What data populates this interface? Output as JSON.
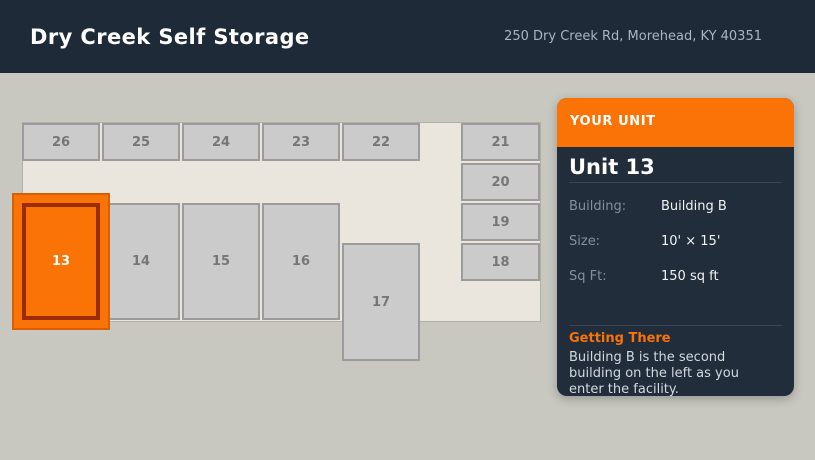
{
  "header": {
    "title": "Dry Creek Self Storage",
    "address": "250 Dry Creek Rd, Morehead, KY 40351"
  },
  "map": {
    "units": [
      {
        "label": "26",
        "x": 22,
        "y": 123,
        "w": 78,
        "h": 38,
        "highlighted": false
      },
      {
        "label": "25",
        "x": 102,
        "y": 123,
        "w": 78,
        "h": 38,
        "highlighted": false
      },
      {
        "label": "24",
        "x": 182,
        "y": 123,
        "w": 78,
        "h": 38,
        "highlighted": false
      },
      {
        "label": "23",
        "x": 262,
        "y": 123,
        "w": 78,
        "h": 38,
        "highlighted": false
      },
      {
        "label": "22",
        "x": 342,
        "y": 123,
        "w": 78,
        "h": 38,
        "highlighted": false
      },
      {
        "label": "21",
        "x": 461,
        "y": 123,
        "w": 79,
        "h": 38,
        "highlighted": false
      },
      {
        "label": "20",
        "x": 461,
        "y": 163,
        "w": 79,
        "h": 38,
        "highlighted": false
      },
      {
        "label": "19",
        "x": 461,
        "y": 203,
        "w": 79,
        "h": 38,
        "highlighted": false
      },
      {
        "label": "18",
        "x": 461,
        "y": 243,
        "w": 79,
        "h": 38,
        "highlighted": false
      },
      {
        "label": "14",
        "x": 102,
        "y": 203,
        "w": 78,
        "h": 117,
        "highlighted": false
      },
      {
        "label": "15",
        "x": 182,
        "y": 203,
        "w": 78,
        "h": 117,
        "highlighted": false
      },
      {
        "label": "16",
        "x": 262,
        "y": 203,
        "w": 78,
        "h": 117,
        "highlighted": false
      },
      {
        "label": "17",
        "x": 342,
        "y": 243,
        "w": 78,
        "h": 118,
        "highlighted": false
      },
      {
        "label": "13",
        "x": 22,
        "y": 203,
        "w": 78,
        "h": 117,
        "highlighted": true
      }
    ]
  },
  "panel": {
    "header_label": "YOUR UNIT",
    "title": "Unit 13",
    "rows": [
      {
        "label": "Building:",
        "value": "Building B"
      },
      {
        "label": "Size:",
        "value": "10' × 15'"
      },
      {
        "label": "Sq Ft:",
        "value": "150 sq ft"
      }
    ],
    "directions_title": "Getting There",
    "directions_text": "Building B is the second building on the left as you enter the facility."
  },
  "colors": {
    "accent_orange": "#f97306",
    "highlight_border": "#9b2c00",
    "header_bg": "#1e2a37",
    "panel_bg": "#212d3a",
    "page_bg": "#c8c8c1",
    "footprint_bg": "#eae6dd",
    "unit_fill": "#cbcbcb",
    "unit_border": "#9b9b9b",
    "divider": "#3a4654"
  }
}
